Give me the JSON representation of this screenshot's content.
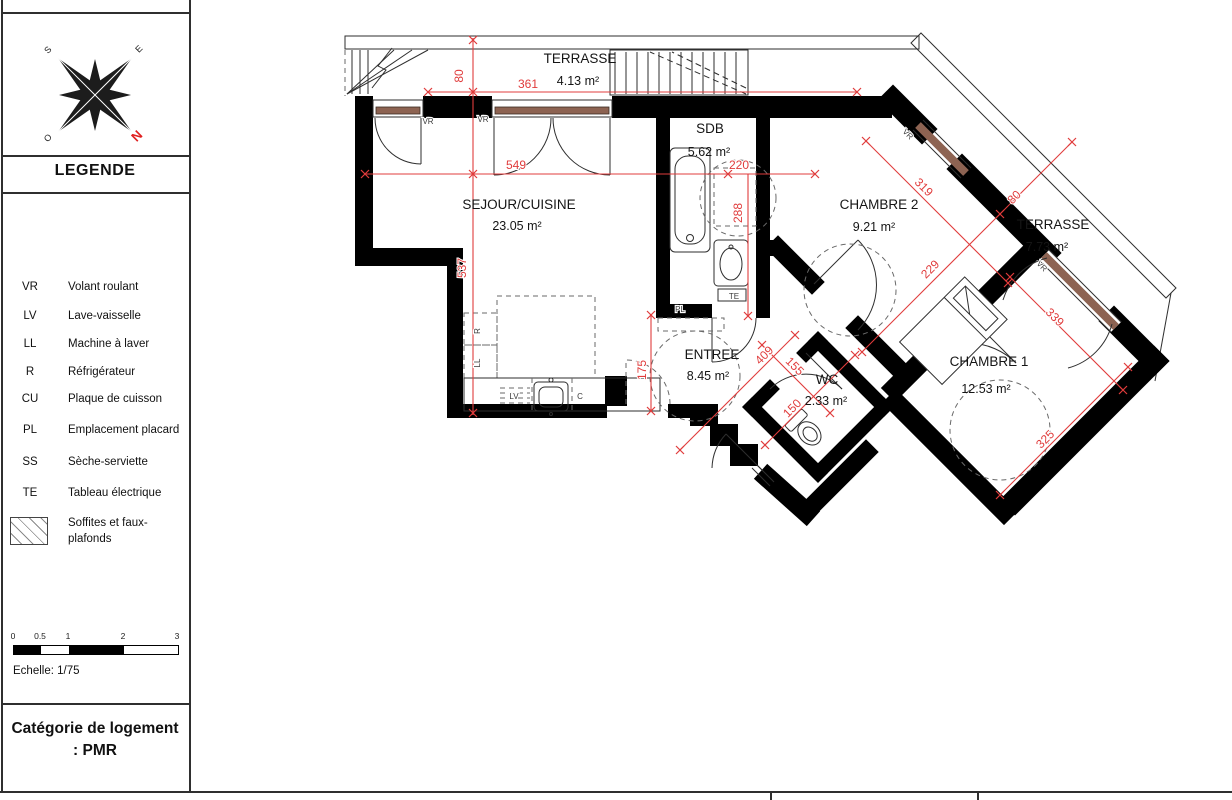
{
  "sidebar": {
    "legend_title": "LEGENDE",
    "compass": {
      "n": "N",
      "s": "S",
      "e": "E",
      "o": "O"
    },
    "legend_items": [
      {
        "abbr": "VR",
        "label": "Volant roulant"
      },
      {
        "abbr": "LV",
        "label": "Lave-vaisselle"
      },
      {
        "abbr": "LL",
        "label": "Machine à laver"
      },
      {
        "abbr": "R",
        "label": "Réfrigérateur"
      },
      {
        "abbr": "CU",
        "label": "Plaque de cuisson"
      },
      {
        "abbr": "PL",
        "label": "Emplacement placard"
      },
      {
        "abbr": "SS",
        "label": "Sèche-serviette"
      },
      {
        "abbr": "TE",
        "label": "Tableau électrique"
      }
    ],
    "soffites_label_line1": "Soffites et faux-",
    "soffites_label_line2": "plafonds",
    "scale": {
      "ticks": [
        "0",
        "0.5",
        "1",
        "2",
        "3"
      ],
      "label": "Echelle: 1/75"
    },
    "category_line1": "Catégorie de logement",
    "category_line2": ": PMR"
  },
  "plan": {
    "rooms": {
      "terrasse_top": {
        "name": "TERRASSE",
        "area": "4.13 m²"
      },
      "sdb": {
        "name": "SDB",
        "area": "5.62 m²"
      },
      "sejour": {
        "name": "SEJOUR/CUISINE",
        "area": "23.05 m²"
      },
      "chambre2": {
        "name": "CHAMBRE 2",
        "area": "9.21 m²"
      },
      "terrasse_right": {
        "name": "TERRASSE",
        "area": "7.73 m²"
      },
      "entree": {
        "name": "ENTREE",
        "area": "8.45 m²"
      },
      "wc": {
        "name": "WC",
        "area": "2.33 m²"
      },
      "chambre1": {
        "name": "CHAMBRE 1",
        "area": "12.53 m²"
      }
    },
    "dims": {
      "terrace_top_depth": "80",
      "terrace_top_width": "361",
      "sejour_width": "549",
      "sdb_width": "220",
      "sdb_height": "288",
      "sejour_height": "537",
      "kitchen_opening": "175",
      "c2_window_wall": "319",
      "c2_depth": "229",
      "terrace_right_depth": "80",
      "entree_length": "409",
      "wc_width": "155",
      "wc_depth": "150",
      "c1_window_wall": "339",
      "c1_depth": "325"
    },
    "tags": {
      "vr_a": "VR",
      "vr_b": "VR",
      "vr_c": "VR",
      "vr_d": "VR",
      "te": "TE",
      "pl": "PL",
      "refrigerateur": "R",
      "lave_linge": "LL",
      "lave_vaisselle": "LV",
      "cuisson": "C"
    },
    "colors": {
      "dimension_red": "#e03c3c",
      "window_sill_brown": "#8d6352"
    }
  }
}
